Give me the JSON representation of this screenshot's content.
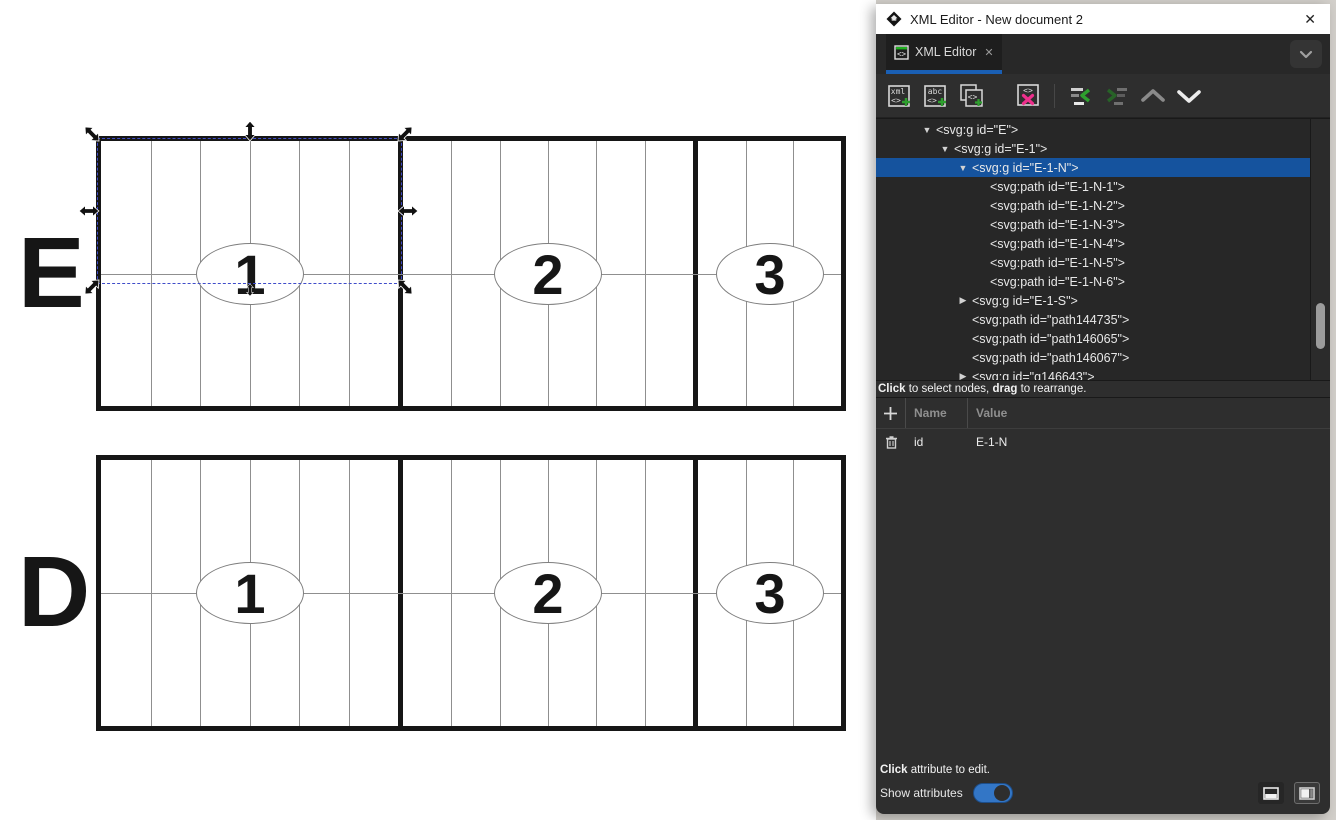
{
  "window": {
    "title": "XML Editor - New document 2",
    "close_glyph": "✕"
  },
  "tab": {
    "label": "XML Editor",
    "close_glyph": "✕"
  },
  "toolbar": {
    "icons": [
      {
        "name": "new-element-node-icon",
        "enabled": true
      },
      {
        "name": "new-text-node-icon",
        "enabled": true
      },
      {
        "name": "duplicate-node-icon",
        "enabled": true
      },
      {
        "name": "delete-node-icon",
        "enabled": true
      },
      {
        "name": "unindent-node-icon",
        "enabled": true
      },
      {
        "name": "indent-node-icon",
        "enabled": false
      },
      {
        "name": "move-node-up-icon",
        "enabled": false
      },
      {
        "name": "move-node-down-icon",
        "enabled": true
      }
    ]
  },
  "xml_tree": {
    "rows": [
      {
        "indent": 2,
        "expander": "expanded",
        "text": "<svg:g id=\"E\">",
        "selected": false
      },
      {
        "indent": 3,
        "expander": "expanded",
        "text": "<svg:g id=\"E-1\">",
        "selected": false
      },
      {
        "indent": 4,
        "expander": "expanded",
        "text": "<svg:g id=\"E-1-N\">",
        "selected": true
      },
      {
        "indent": 5,
        "expander": "none",
        "text": "<svg:path id=\"E-1-N-1\">",
        "selected": false
      },
      {
        "indent": 5,
        "expander": "none",
        "text": "<svg:path id=\"E-1-N-2\">",
        "selected": false
      },
      {
        "indent": 5,
        "expander": "none",
        "text": "<svg:path id=\"E-1-N-3\">",
        "selected": false
      },
      {
        "indent": 5,
        "expander": "none",
        "text": "<svg:path id=\"E-1-N-4\">",
        "selected": false
      },
      {
        "indent": 5,
        "expander": "none",
        "text": "<svg:path id=\"E-1-N-5\">",
        "selected": false
      },
      {
        "indent": 5,
        "expander": "none",
        "text": "<svg:path id=\"E-1-N-6\">",
        "selected": false
      },
      {
        "indent": 4,
        "expander": "collapsed",
        "text": "<svg:g id=\"E-1-S\">",
        "selected": false
      },
      {
        "indent": 4,
        "expander": "none",
        "text": "<svg:path id=\"path144735\">",
        "selected": false
      },
      {
        "indent": 4,
        "expander": "none",
        "text": "<svg:path id=\"path146065\">",
        "selected": false
      },
      {
        "indent": 4,
        "expander": "none",
        "text": "<svg:path id=\"path146067\">",
        "selected": false
      },
      {
        "indent": 4,
        "expander": "collapsed",
        "text": "<svg:g id=\"g146643\">",
        "selected": false
      }
    ],
    "hint": {
      "b1": "Click",
      "t1": " to select nodes, ",
      "b2": "drag",
      "t2": " to rearrange."
    }
  },
  "attributes": {
    "name_header": "Name",
    "value_header": "Value",
    "rows": [
      {
        "name": "id",
        "value": "E-1-N"
      }
    ],
    "hint_bold": "Click",
    "hint_rest": " attribute to edit.",
    "show_attributes_label": "Show attributes",
    "show_attributes_toggle": "on",
    "layout_buttons": [
      "horizontal-split-layout-icon",
      "vertical-split-layout-icon"
    ]
  },
  "canvas": {
    "strips": [
      {
        "label": "E",
        "x": 96,
        "y": 136,
        "w": 750,
        "h": 275,
        "panels": [
          {
            "number": "1",
            "x0": 0,
            "x1": 297,
            "columns": 6
          },
          {
            "number": "2",
            "x0": 302,
            "x1": 592,
            "columns": 6
          },
          {
            "number": "3",
            "x0": 597,
            "x1": 740,
            "columns": 3
          }
        ]
      },
      {
        "label": "D",
        "x": 96,
        "y": 455,
        "w": 750,
        "h": 276,
        "panels": [
          {
            "number": "1",
            "x0": 0,
            "x1": 297,
            "columns": 6
          },
          {
            "number": "2",
            "x0": 302,
            "x1": 592,
            "columns": 6
          },
          {
            "number": "3",
            "x0": 597,
            "x1": 740,
            "columns": 3
          }
        ]
      }
    ],
    "selection": {
      "x": 97,
      "y": 138,
      "w": 305,
      "h": 146,
      "target": "E-1-N"
    }
  },
  "colors": {
    "tree_selection_blue": "#15539e",
    "tab_underline_blue": "#1a5fb4",
    "toolbar_accent_green": "#2ea02e",
    "delete_pink": "#ee2e8c",
    "toggle_blue": "#3376c6",
    "canvas_selection_dash_blue": "#3f4cc9",
    "dialog_bg": "#2e2e2e",
    "stroke_black": "#161616"
  }
}
